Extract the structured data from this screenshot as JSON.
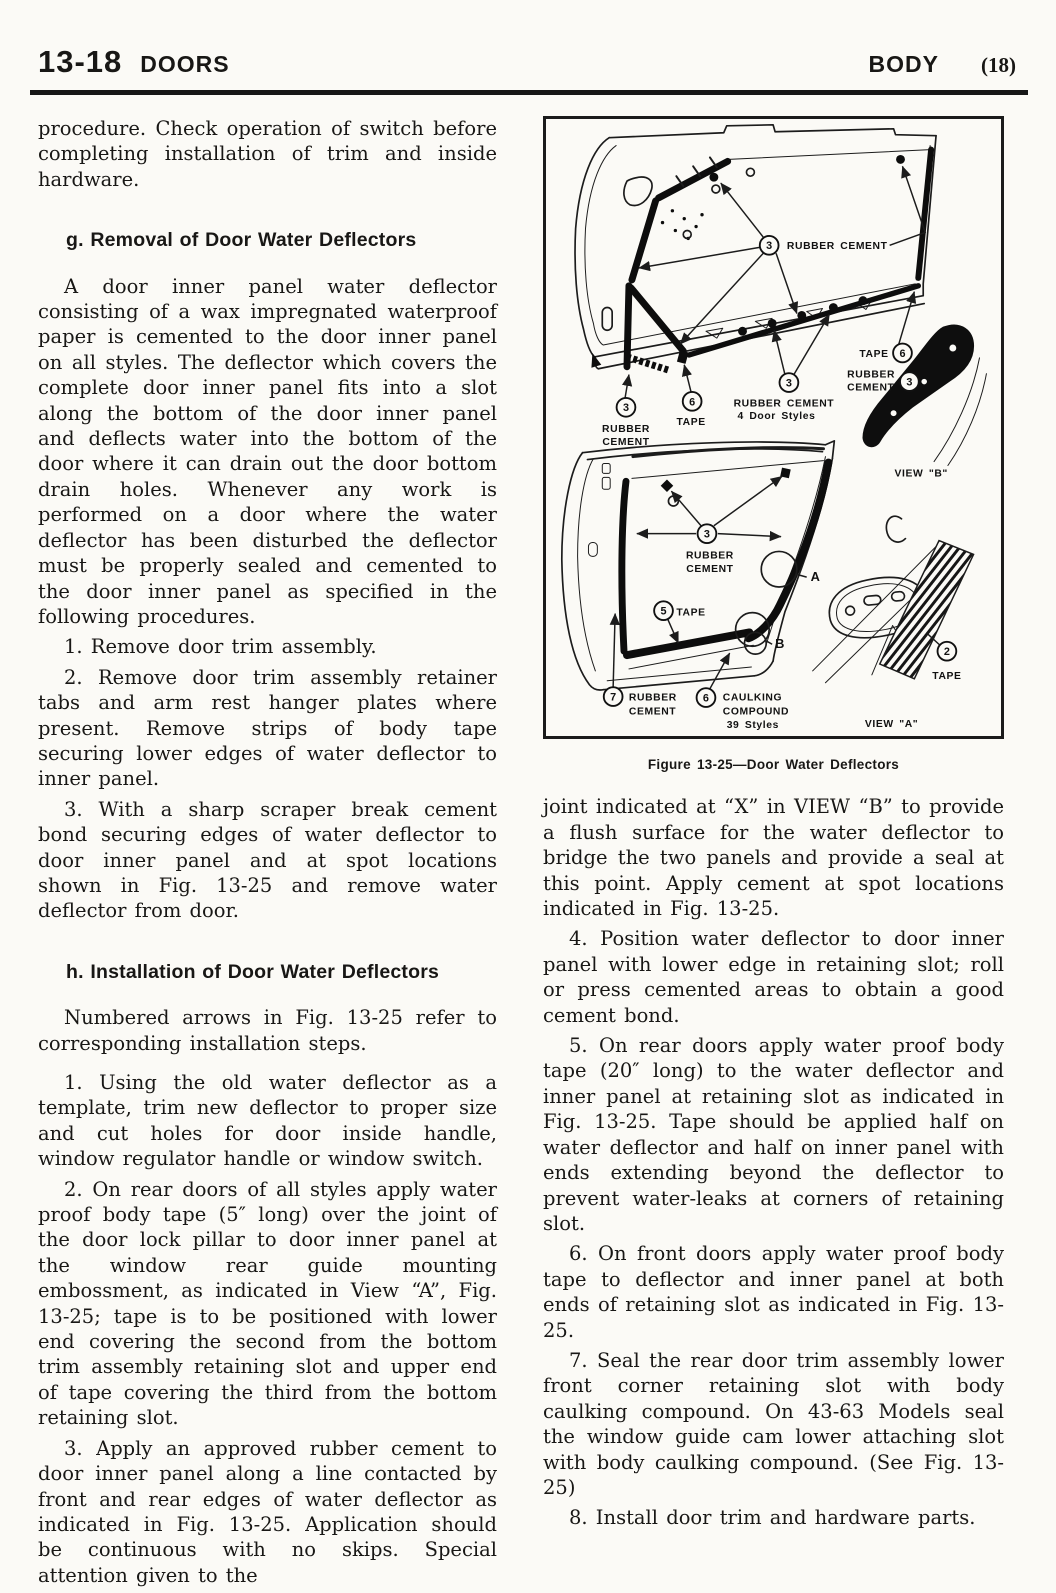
{
  "header": {
    "section_number": "13-18",
    "section_title": "DOORS",
    "right_title": "BODY",
    "page_number": "(18)"
  },
  "left_column": {
    "intro_paragraph": "procedure. Check operation of switch before completing installation of trim and inside hardware.",
    "section_g": {
      "heading": "g. Removal of Door Water Deflectors",
      "paragraph": "A door inner panel water deflector consisting of a wax impregnated waterproof paper is cemented to the door inner panel on all styles. The deflector which covers the complete door inner panel fits into a slot along the bottom of the door inner panel and deflects water into the bottom of the door where it can drain out the door bottom drain holes. Whenever any work is performed on a door where the water deflector has been disturbed the deflector must be properly sealed and cemented to the door inner panel as specified in the following procedures.",
      "steps": [
        "1.  Remove door trim assembly.",
        "2.  Remove door trim assembly retainer tabs and arm rest hanger plates where present. Remove strips of body tape securing lower edges of water deflector to inner panel.",
        "3.  With a sharp scraper break cement bond securing edges of water deflector to door inner panel and at spot locations shown in Fig. 13-25 and remove water deflector from door."
      ]
    },
    "section_h": {
      "heading": "h. Installation of Door Water Deflectors",
      "intro": "Numbered arrows in Fig. 13-25 refer to corresponding installation steps.",
      "steps": [
        "1.  Using the old water deflector as a template, trim new deflector to proper size and cut holes for door inside handle, window regulator handle or window switch.",
        "2.  On rear doors of all styles apply water proof body tape (5″ long) over the joint of the door lock pillar to door inner panel at the window rear guide mounting embossment, as indicated in View “A”, Fig. 13-25; tape is to be positioned with lower end covering the second from the bottom trim assembly retaining slot and upper end of tape covering the third from the bottom retaining slot.",
        "3.  Apply an approved rubber cement to door inner panel along a line contacted by front and rear edges of water deflector as indicated in Fig. 13-25. Application should be continuous with no skips. Special attention given to the"
      ]
    }
  },
  "figure": {
    "caption": "Figure 13-25—Door Water Deflectors",
    "badges": [
      {
        "n": "3",
        "x": 226,
        "y": 127
      },
      {
        "n": "6",
        "x": 361,
        "y": 236
      },
      {
        "n": "3",
        "x": 368,
        "y": 265
      },
      {
        "n": "3",
        "x": 246,
        "y": 266
      },
      {
        "n": "3",
        "x": 81,
        "y": 291
      },
      {
        "n": "6",
        "x": 148,
        "y": 285
      },
      {
        "n": "3",
        "x": 163,
        "y": 419
      },
      {
        "n": "5",
        "x": 119,
        "y": 497
      },
      {
        "n": "7",
        "x": 68,
        "y": 584
      },
      {
        "n": "6",
        "x": 162,
        "y": 585
      },
      {
        "n": "2",
        "x": 406,
        "y": 538
      }
    ],
    "labels": [
      {
        "text": "RUBBER CEMENT",
        "x": 244,
        "y": 131,
        "anchor": "start"
      },
      {
        "text": "TAPE",
        "x": 347,
        "y": 240,
        "anchor": "end"
      },
      {
        "text": "RUBBER",
        "x": 305,
        "y": 261,
        "anchor": "start"
      },
      {
        "text": "CEMENT",
        "x": 305,
        "y": 274,
        "anchor": "start"
      },
      {
        "text": "RUBBER CEMENT",
        "x": 190,
        "y": 290,
        "anchor": "start"
      },
      {
        "text": "4 Door Styles",
        "x": 194,
        "y": 303,
        "anchor": "start"
      },
      {
        "text": "RUBBER",
        "x": 81,
        "y": 316,
        "anchor": "middle"
      },
      {
        "text": "CEMENT",
        "x": 81,
        "y": 329,
        "anchor": "middle"
      },
      {
        "text": "TAPE",
        "x": 147,
        "y": 309,
        "anchor": "middle"
      },
      {
        "text": "VIEW \"B\"",
        "x": 380,
        "y": 361,
        "anchor": "middle"
      },
      {
        "text": "RUBBER",
        "x": 166,
        "y": 444,
        "anchor": "middle"
      },
      {
        "text": "CEMENT",
        "x": 166,
        "y": 458,
        "anchor": "middle"
      },
      {
        "text": "A",
        "x": 268,
        "y": 467,
        "anchor": "start",
        "big": true
      },
      {
        "text": "TAPE",
        "x": 132,
        "y": 502,
        "anchor": "start"
      },
      {
        "text": "B",
        "x": 232,
        "y": 535,
        "anchor": "start",
        "big": true
      },
      {
        "text": "RUBBER",
        "x": 84,
        "y": 588,
        "anchor": "start"
      },
      {
        "text": "CEMENT",
        "x": 84,
        "y": 602,
        "anchor": "start"
      },
      {
        "text": "CAULKING",
        "x": 179,
        "y": 588,
        "anchor": "start"
      },
      {
        "text": "COMPOUND",
        "x": 179,
        "y": 602,
        "anchor": "start"
      },
      {
        "text": "39 Styles",
        "x": 183,
        "y": 616,
        "anchor": "start"
      },
      {
        "text": "VIEW \"A\"",
        "x": 350,
        "y": 615,
        "anchor": "middle"
      },
      {
        "text": "TAPE",
        "x": 406,
        "y": 566,
        "anchor": "middle"
      }
    ]
  },
  "right_column": {
    "continuation": "joint indicated at “X” in VIEW “B” to provide a flush surface for the water deflector to bridge the two panels and provide a seal at this point. Apply cement at spot locations indicated in Fig. 13-25.",
    "steps": [
      "4.  Position water deflector to door inner panel with lower edge in retaining slot; roll or press cemented areas to obtain a good cement bond.",
      "5.  On rear doors apply water proof body tape (20″ long) to the water deflector and inner panel at retaining slot as indicated in Fig. 13-25. Tape should be applied half on water deflector and half on inner panel with ends extending beyond the deflector to prevent water-leaks at corners of retaining slot.",
      "6.  On front doors apply water proof body tape to deflector and inner panel at both ends of retaining slot as indicated in Fig. 13-25.",
      "7.  Seal the rear door trim assembly lower front corner retaining slot with body caulking compound. On 43-63 Models seal the window guide cam lower attaching slot with body caulking compound. (See Fig. 13-25)",
      "8.  Install door trim and hardware parts."
    ]
  }
}
